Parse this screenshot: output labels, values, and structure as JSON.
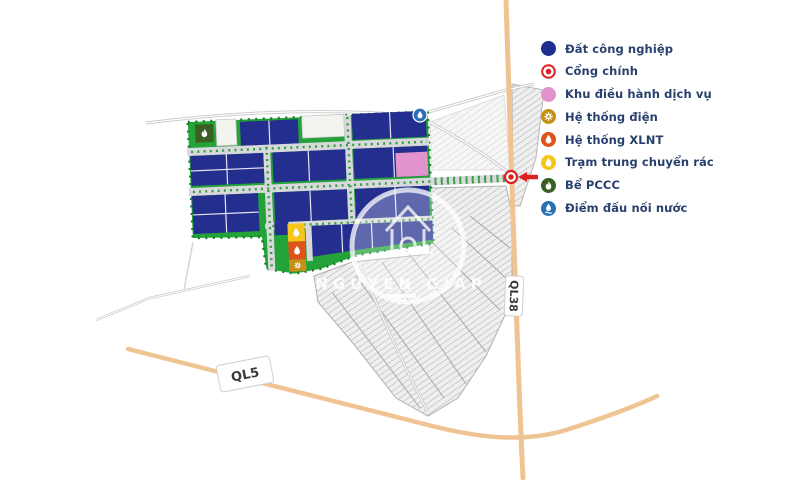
{
  "legend": {
    "items": [
      {
        "id": "industrial-land",
        "label": "Đất công nghiệp",
        "color": "#1e2f8f"
      },
      {
        "id": "main-gate",
        "label": "Cổng chính",
        "color": "#df2020"
      },
      {
        "id": "service-area",
        "label": "Khu điều hành dịch vụ",
        "color": "#e093cd"
      },
      {
        "id": "electric-system",
        "label": "Hệ thống điện",
        "color": "#c49018"
      },
      {
        "id": "wastewater-system",
        "label": "Hệ thống XLNT",
        "color": "#dd5318"
      },
      {
        "id": "waste-transfer",
        "label": "Trạm trung chuyển rác",
        "color": "#f6c51a"
      },
      {
        "id": "fire-tank",
        "label": "Bể PCCC",
        "color": "#3a5f22"
      },
      {
        "id": "water-connection",
        "label": "Điểm đấu nối nước",
        "color": "#2a70b6"
      }
    ]
  },
  "map": {
    "road_labels": {
      "ql5": "QL5",
      "ql38": "QL38"
    },
    "watermark_text": "NGUYEN GIAP",
    "colors": {
      "industrial_lot": "#232e8e",
      "park_green": "#23a338",
      "road_gray": "#d9d9dd",
      "highway_tan": "#f0c392",
      "service_lot": "#f0a0da",
      "gate_red": "#df2020"
    }
  }
}
